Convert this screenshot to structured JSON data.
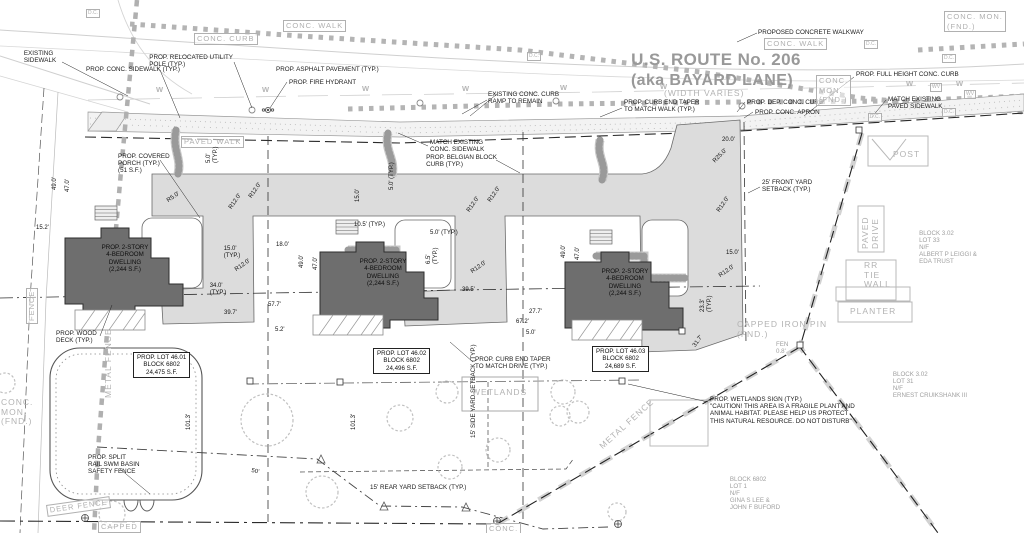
{
  "road": {
    "title_line1": "U.S. ROUTE No. 206",
    "title_line2": "(aka BAYARD LANE)",
    "labels": [
      {
        "n": "proposed-concrete-walkway-label",
        "t": "PROPOSED CONCRETE WALKWAY",
        "x": 758,
        "y": 29,
        "s": "b"
      },
      {
        "n": "existing-sidewalk-label",
        "t": "EXISTING\nSIDEWALK",
        "x": 40,
        "y": 50,
        "s": "b",
        "a": "c"
      },
      {
        "n": "prop-conc-sidewalk-label",
        "t": "PROP. CONC. SIDEWALK (TYP.)",
        "x": 86,
        "y": 66,
        "s": "b"
      },
      {
        "n": "prop-relocated-utility-pole-label",
        "t": "PROP. RELOCATED UTILITY\nPOLE (TYP.)",
        "x": 233,
        "y": 54,
        "s": "b",
        "a": "r"
      },
      {
        "n": "prop-asphalt-pavement-label",
        "t": "PROP. ASPHALT PAVEMENT (TYP.)",
        "x": 276,
        "y": 66,
        "s": "b"
      },
      {
        "n": "prop-fire-hydrant-label",
        "t": "PROP. FIRE HYDRANT",
        "x": 289,
        "y": 79,
        "s": "b"
      },
      {
        "n": "existing-conc-curb-ramp-label",
        "t": "EXISTING CONC. CURB\nRAMP TO REMAIN",
        "x": 488,
        "y": 91,
        "s": "b"
      },
      {
        "n": "curb-end-taper-walk-label",
        "t": "PROP. CURB END TAPER\nTO MATCH WALK (TYP.)",
        "x": 624,
        "y": 99,
        "s": "b"
      },
      {
        "n": "width-varies-label",
        "t": "(WIDTH VARIES)",
        "x": 664,
        "y": 89,
        "s": "go"
      },
      {
        "n": "prop-dep-conc-curb-label",
        "t": "PROP. DEP. CONC. CURB",
        "x": 747,
        "y": 99,
        "s": "b"
      },
      {
        "n": "prop-conc-apron-label",
        "t": "PROP. CONC. APRON",
        "x": 755,
        "y": 109,
        "s": "b"
      },
      {
        "n": "prop-full-height-curb-label",
        "t": "PROP. FULL HEIGHT CONC. CURB",
        "x": 856,
        "y": 71,
        "s": "b"
      },
      {
        "n": "match-existing-paved-sidewalk-label",
        "t": "MATCH EXISTING\nPAVED SIDEWALK",
        "x": 888,
        "y": 96,
        "s": "b"
      },
      {
        "n": "conc-walk-tag-1",
        "t": "CONC. WALK",
        "x": 283,
        "y": 20,
        "s": "gb"
      },
      {
        "n": "conc-curb-tag",
        "t": "CONC. CURB",
        "x": 194,
        "y": 33,
        "s": "gb"
      },
      {
        "n": "conc-walk-tag-2",
        "t": "CONC. WALK",
        "x": 764,
        "y": 38,
        "s": "gb"
      },
      {
        "n": "conc-mon-fnd-tag-ne",
        "t": "CONC. MON.\n(FND.)",
        "x": 944,
        "y": 11,
        "s": "gb"
      },
      {
        "n": "conc-mon-fnd-tag-mid",
        "t": "CONC.\nMON.\n(FND.)",
        "x": 816,
        "y": 75,
        "s": "gb"
      },
      {
        "n": "paved-walk-tag",
        "t": "PAVED WALK",
        "x": 181,
        "y": 136,
        "s": "gb"
      }
    ]
  },
  "site": {
    "labels": [
      {
        "n": "match-existing-conc-sidewalk-label",
        "t": "MATCH EXISTING\nCONC. SIDEWALK",
        "x": 430,
        "y": 139,
        "s": "b"
      },
      {
        "n": "belgian-block-curb-label",
        "t": "PROP. BELGIAN BLOCK\nCURB (TYP.)",
        "x": 497,
        "y": 154,
        "s": "b",
        "a": "r"
      },
      {
        "n": "covered-porch-label",
        "t": "PROP. COVERED\nPORCH (TYP.)\n(51 S.F.)",
        "x": 118,
        "y": 153,
        "s": "b"
      },
      {
        "n": "front-yard-setback-label",
        "t": "25' FRONT YARD\nSETBACK (TYP.)",
        "x": 762,
        "y": 179,
        "s": "b"
      },
      {
        "n": "wood-deck-label",
        "t": "PROP. WOOD\nDECK (TYP.)",
        "x": 56,
        "y": 330,
        "s": "b"
      },
      {
        "n": "curb-end-taper-drive-label",
        "t": "PROP. CURB END TAPER\nTO MATCH DRIVE (TYP.)",
        "x": 475,
        "y": 356,
        "s": "b"
      },
      {
        "n": "wetlands-sign-label",
        "t": "PROP. WETLANDS SIGN (TYP.)\n\"CAUTION! THIS AREA IS A FRAGILE PLANT AND\nANIMAL HABITAT. PLEASE HELP US PROTECT\nTHIS NATURAL RESOURCE. DO NOT DISTURB\"",
        "x": 710,
        "y": 396,
        "s": "b"
      },
      {
        "n": "swm-fence-label",
        "t": "PROP. SPLIT\nRAIL SWM BASIN\nSAFETY FENCE",
        "x": 88,
        "y": 454,
        "s": "b"
      },
      {
        "n": "rear-setback-label",
        "t": "15' REAR YARD SETBACK (TYP.)",
        "x": 370,
        "y": 484,
        "s": "b"
      },
      {
        "n": "side-setback-label",
        "t": "15' SIDE YARD SETBACK (TYP.)",
        "x": 470,
        "y": 438,
        "s": "b",
        "r": -90
      },
      {
        "n": "wetlands-tag",
        "t": "WETLANDS",
        "x": 472,
        "y": 388,
        "s": "go"
      },
      {
        "n": "post-tag",
        "t": "POST",
        "x": 893,
        "y": 150,
        "s": "go"
      },
      {
        "n": "paved-drive-tag",
        "t": "PAVED\nDRIVE",
        "x": 861,
        "y": 249,
        "s": "go",
        "r": -90
      },
      {
        "n": "rr-tie-wall-tag",
        "t": "RR\nTIE\nWALL",
        "x": 864,
        "y": 261,
        "s": "go"
      },
      {
        "n": "planter-tag",
        "t": "PLANTER",
        "x": 850,
        "y": 307,
        "s": "go"
      },
      {
        "n": "metal-fence-tag-vertical",
        "t": "METAL FENCE",
        "x": 104,
        "y": 398,
        "s": "go",
        "r": -90
      },
      {
        "n": "metal-fence-tag-diagonal",
        "t": "METAL FENCE",
        "x": 598,
        "y": 444,
        "s": "go",
        "r": -42
      },
      {
        "n": "deer-fence-tag",
        "t": "DEER FENCE",
        "x": 46,
        "y": 505,
        "s": "gb",
        "r": -8
      },
      {
        "n": "capped-tag",
        "t": "CAPPED",
        "x": 98,
        "y": 521,
        "s": "gb"
      },
      {
        "n": "fence-tag",
        "t": "FENCE",
        "x": 26,
        "y": 324,
        "s": "gb",
        "r": -90
      },
      {
        "n": "conc-corner-tag",
        "t": "CONC.",
        "x": 486,
        "y": 523,
        "s": "gb"
      },
      {
        "n": "capped-iron-pin-label",
        "t": "CAPPED IRON PIN\n(FND.)",
        "x": 737,
        "y": 320,
        "s": "go"
      },
      {
        "n": "fen-offset-note",
        "t": "FEN\n0.8'",
        "x": 776,
        "y": 341,
        "s": "g"
      },
      {
        "n": "conc-mon-left-tag",
        "t": "CONC.\nMON.\n(FND.)",
        "x": 1,
        "y": 398,
        "s": "go"
      }
    ]
  },
  "neighbors": [
    {
      "n": "neighbor-lot-33",
      "t": "BLOCK 3.02\nLOT 33\nN/F\nALBERT P LEIGGI &\nEDA TRUST",
      "x": 948,
      "y": 230,
      "s": "g",
      "a": "c"
    },
    {
      "n": "neighbor-lot-31",
      "t": "BLOCK 3.02\nLOT 31\nN/F\nERNEST CRUIKSHANK III",
      "x": 930,
      "y": 371,
      "s": "g",
      "a": "c"
    },
    {
      "n": "neighbor-lot-1",
      "t": "BLOCK 6802\nLOT 1\nN/F\nGINA S LEE &\nJOHN F BUFORD",
      "x": 755,
      "y": 476,
      "s": "g",
      "a": "c"
    }
  ],
  "lots": [
    {
      "n": "lot-4601-box",
      "t": "PROP. LOT 46.01\nBLOCK 6802\n24,475 S.F.",
      "x": 133,
      "y": 352,
      "s": "bb"
    },
    {
      "n": "lot-4602-box",
      "t": "PROP. LOT 46.02\nBLOCK 6802\n24,496 S.F.",
      "x": 373,
      "y": 348,
      "s": "bb"
    },
    {
      "n": "lot-4603-box",
      "t": "PROP. LOT 46.03\nBLOCK 6802\n24,689 S.F.",
      "x": 592,
      "y": 346,
      "s": "bb"
    }
  ],
  "houses": {
    "label": "PROP. 2-STORY\n4-BEDROOM\nDWELLING\n(2,244 S.F.)",
    "positions": [
      {
        "x": 125,
        "y": 244
      },
      {
        "x": 383,
        "y": 258
      },
      {
        "x": 625,
        "y": 268
      }
    ]
  },
  "dimensions": [
    {
      "t": "49.0'",
      "x": 52,
      "y": 190,
      "r": -90
    },
    {
      "t": "47.0'",
      "x": 65,
      "y": 192,
      "r": -90
    },
    {
      "t": "15.2'",
      "x": 36,
      "y": 225
    },
    {
      "t": "5.0'\n(TYP.)",
      "x": 206,
      "y": 163,
      "r": -90
    },
    {
      "t": "15.0'",
      "x": 355,
      "y": 202,
      "r": -90
    },
    {
      "t": "49.0'",
      "x": 299,
      "y": 268,
      "r": -90
    },
    {
      "t": "47.0'",
      "x": 313,
      "y": 270,
      "r": -90
    },
    {
      "t": "5.0' (TYP.)",
      "x": 389,
      "y": 190,
      "r": -90
    },
    {
      "t": "10.5' (TYP.)",
      "x": 354,
      "y": 222
    },
    {
      "t": "5.0' (TYP.)",
      "x": 430,
      "y": 230
    },
    {
      "t": "6.5'\n(TYP.)",
      "x": 426,
      "y": 264,
      "r": -90
    },
    {
      "t": "49.0'",
      "x": 561,
      "y": 258,
      "r": -90
    },
    {
      "t": "47.0'",
      "x": 575,
      "y": 260,
      "r": -90
    },
    {
      "t": "R5.0'",
      "x": 166,
      "y": 199,
      "r": -35
    },
    {
      "t": "R12.0'",
      "x": 228,
      "y": 207,
      "r": -55
    },
    {
      "t": "R12.0'",
      "x": 248,
      "y": 196,
      "r": -55
    },
    {
      "t": "R12.0'",
      "x": 234,
      "y": 268,
      "r": -35
    },
    {
      "t": "15.0'\n(TYP.)",
      "x": 232,
      "y": 246,
      "a": "c"
    },
    {
      "t": "18.0'",
      "x": 276,
      "y": 242
    },
    {
      "t": "34.0'\n(TYP.)",
      "x": 218,
      "y": 283,
      "a": "c"
    },
    {
      "t": "57.7'",
      "x": 268,
      "y": 302
    },
    {
      "t": "39.7'",
      "x": 224,
      "y": 310
    },
    {
      "t": "5.2'",
      "x": 275,
      "y": 327
    },
    {
      "t": "R12.0'",
      "x": 466,
      "y": 210,
      "r": -55
    },
    {
      "t": "R12.0'",
      "x": 487,
      "y": 200,
      "r": -55
    },
    {
      "t": "R12.0'",
      "x": 470,
      "y": 270,
      "r": -35
    },
    {
      "t": "39.5'",
      "x": 462,
      "y": 287
    },
    {
      "t": "27.7'",
      "x": 529,
      "y": 309
    },
    {
      "t": "67.2'",
      "x": 516,
      "y": 319
    },
    {
      "t": "5.0'",
      "x": 526,
      "y": 330
    },
    {
      "t": "20.0'",
      "x": 722,
      "y": 137
    },
    {
      "t": "R25.0'",
      "x": 712,
      "y": 160,
      "r": -45
    },
    {
      "t": "R12.0'",
      "x": 716,
      "y": 210,
      "r": -55
    },
    {
      "t": "15.0'",
      "x": 726,
      "y": 250
    },
    {
      "t": "R12.0'",
      "x": 718,
      "y": 274,
      "r": -35
    },
    {
      "t": "23.3'\n(TYP.)",
      "x": 700,
      "y": 312,
      "r": -90
    },
    {
      "t": "101.3'",
      "x": 186,
      "y": 430,
      "r": -90
    },
    {
      "t": "101.3'",
      "x": 351,
      "y": 430,
      "r": -90
    },
    {
      "t": "50'",
      "x": 252,
      "y": 468,
      "r": 12
    },
    {
      "t": "31.7'",
      "x": 692,
      "y": 345,
      "r": -55
    }
  ],
  "water_marker": "W",
  "water_positions": [
    [
      156,
      86
    ],
    [
      262,
      86
    ],
    [
      362,
      85
    ],
    [
      462,
      85
    ],
    [
      560,
      84
    ],
    [
      660,
      83
    ],
    [
      906,
      80
    ],
    [
      956,
      80
    ]
  ],
  "dc_tag": "D.C.",
  "dc_positions": [
    [
      86,
      9
    ],
    [
      527,
      52
    ],
    [
      864,
      40
    ],
    [
      942,
      54
    ],
    [
      868,
      113
    ],
    [
      942,
      108
    ]
  ],
  "wv_tag": "WV",
  "wv_positions": [
    [
      930,
      83
    ],
    [
      964,
      90
    ]
  ],
  "colors": {
    "driveway": "#dcdcdc",
    "house": "#6e6e6e",
    "sidewalk": "#f3f3f3",
    "existing_gray": "#b3b3b3",
    "title_gray": "#999999",
    "ink": "#1a1a1a"
  }
}
